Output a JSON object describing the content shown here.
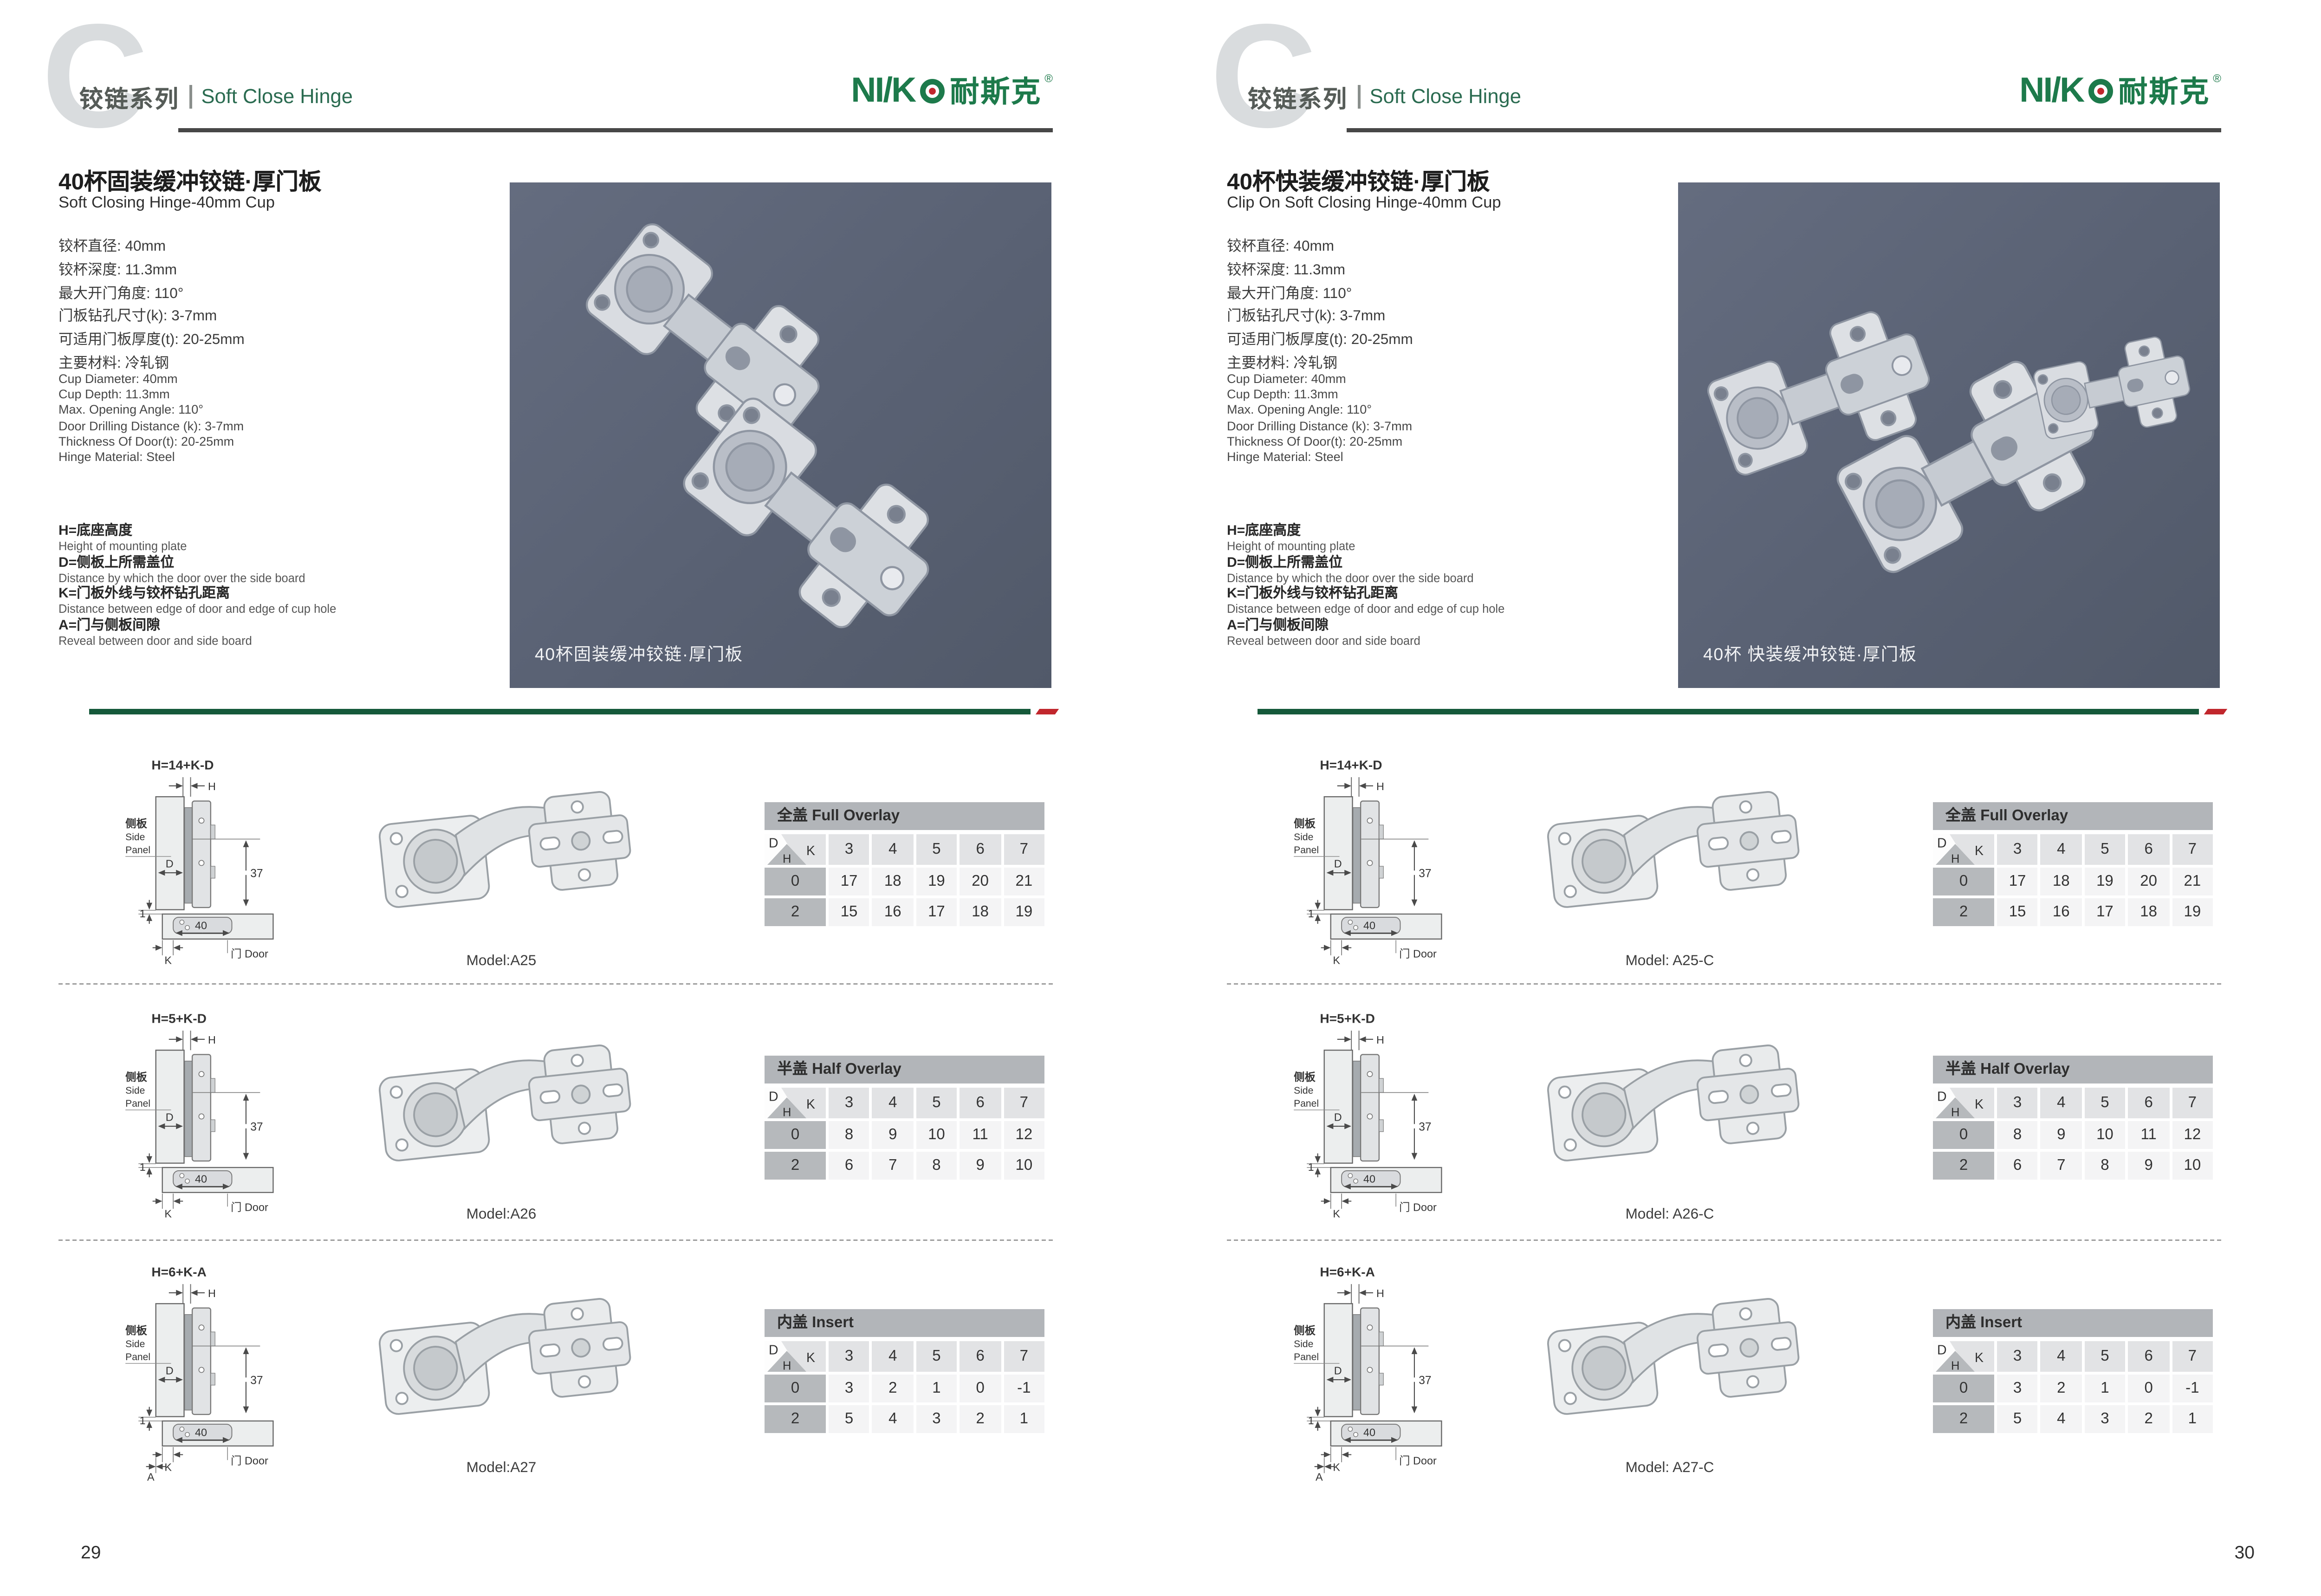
{
  "header": {
    "c_glyph": "C",
    "series_cn": "铰链系列",
    "series_en": "Soft Close Hinge",
    "logo_latin": "NI/K",
    "logo_cn": "耐斯克",
    "logo_reg": "®"
  },
  "page1": {
    "page_number": "29",
    "title_cn": "40杯固装缓冲铰链·厚门板",
    "title_en": "Soft Closing Hinge-40mm Cup",
    "photo_caption": "40杯固装缓冲铰链·厚门板",
    "models": [
      "Model:A25",
      "Model:A26",
      "Model:A27"
    ]
  },
  "page2": {
    "page_number": "30",
    "title_cn": "40杯快装缓冲铰链·厚门板",
    "title_en": "Clip On Soft Closing Hinge-40mm Cup",
    "photo_caption": "40杯 快装缓冲铰链·厚门板",
    "models": [
      "Model: A25-C",
      "Model: A26-C",
      "Model: A27-C"
    ]
  },
  "specs_cn": [
    "铰杯直径: 40mm",
    "铰杯深度: 11.3mm",
    "最大开门角度: 110°",
    "门板钻孔尺寸(k): 3-7mm",
    "可适用门板厚度(t): 20-25mm",
    "主要材料: 冷轧钢"
  ],
  "specs_en": [
    "Cup Diameter: 40mm",
    "Cup Depth: 11.3mm",
    "Max. Opening Angle: 110°",
    "Door Drilling Distance (k): 3-7mm",
    "Thickness Of Door(t): 20-25mm",
    "Hinge Material: Steel"
  ],
  "legend": [
    {
      "cn": "H=底座高度",
      "en": "Height of mounting plate"
    },
    {
      "cn": "D=侧板上所需盖位",
      "en": "Distance by which the door over the side board"
    },
    {
      "cn": "K=门板外线与铰杯钻孔距离",
      "en": "Distance between edge of door and edge of cup hole"
    },
    {
      "cn": "A=门与侧板间隙",
      "en": "Reveal between door and side board"
    }
  ],
  "diagram_labels": {
    "side_panel_cn": "侧板",
    "side_panel_en_1": "Side",
    "side_panel_en_2": "Panel",
    "door": "门 Door",
    "dim_37": "37",
    "dim_40": "40",
    "dim_1": "1",
    "h": "H",
    "d": "D",
    "k": "K",
    "a": "A"
  },
  "diagrams": [
    {
      "formula": "H=14+K-D",
      "show_a": false
    },
    {
      "formula": "H=5+K-D",
      "show_a": false
    },
    {
      "formula": "H=6+K-A",
      "show_a": true
    }
  ],
  "tables": [
    {
      "title": "全盖 Full Overlay",
      "corner": {
        "d": "D",
        "k": "K",
        "h": "H"
      },
      "k_values": [
        "3",
        "4",
        "5",
        "6",
        "7"
      ],
      "rows": [
        {
          "h": "0",
          "values": [
            "17",
            "18",
            "19",
            "20",
            "21"
          ]
        },
        {
          "h": "2",
          "values": [
            "15",
            "16",
            "17",
            "18",
            "19"
          ]
        }
      ]
    },
    {
      "title": "半盖 Half Overlay",
      "corner": {
        "d": "D",
        "k": "K",
        "h": "H"
      },
      "k_values": [
        "3",
        "4",
        "5",
        "6",
        "7"
      ],
      "rows": [
        {
          "h": "0",
          "values": [
            "8",
            "9",
            "10",
            "11",
            "12"
          ]
        },
        {
          "h": "2",
          "values": [
            "6",
            "7",
            "8",
            "9",
            "10"
          ]
        }
      ]
    },
    {
      "title": "内盖 Insert",
      "corner": {
        "d": "D",
        "k": "K",
        "h": "H"
      },
      "k_values": [
        "3",
        "4",
        "5",
        "6",
        "7"
      ],
      "rows": [
        {
          "h": "0",
          "values": [
            "3",
            "2",
            "1",
            "0",
            "-1"
          ]
        },
        {
          "h": "2",
          "values": [
            "5",
            "4",
            "3",
            "2",
            "1"
          ]
        }
      ]
    }
  ],
  "colors": {
    "brand_green": "#1d7a4b",
    "heading_green": "#2a6b50",
    "bar_green": "#15593a",
    "accent_red": "#c1272d",
    "photo_bg": "#596173",
    "table_title_bg": "#b2b5b9",
    "table_header_bg": "#e2e3e5",
    "table_rowlabel_bg": "#b6b9bc",
    "table_value_bg": "#f4f4f5"
  }
}
